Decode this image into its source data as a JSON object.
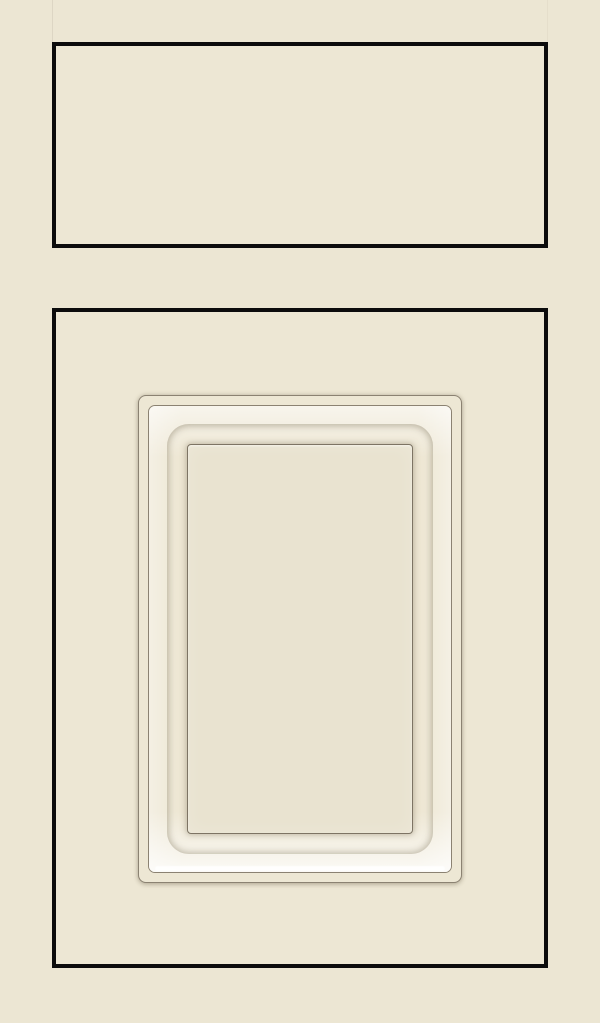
{
  "scene": {
    "description": "Cream painted cabinet sample: slab drawer front above a door with a raised inset-molded center panel, each outlined in black",
    "components": {
      "drawer_front": "drawer-front",
      "door_front": "door-front",
      "raised_panel": "raised-panel",
      "panel_molding": "panel-molding",
      "panel_center_field": "panel-center-field"
    }
  },
  "colors": {
    "background": "#ECE6D3",
    "face": "#EDE7D4",
    "outline": "#0C0C0C",
    "molding_line": "#8B8272",
    "field_line": "#7D7464",
    "bevel_base": "#EDE6D2",
    "bevel_highlight": "#F7F2E2",
    "bevel_shadow": "#D9D2BE",
    "field": "#E9E3D0"
  }
}
